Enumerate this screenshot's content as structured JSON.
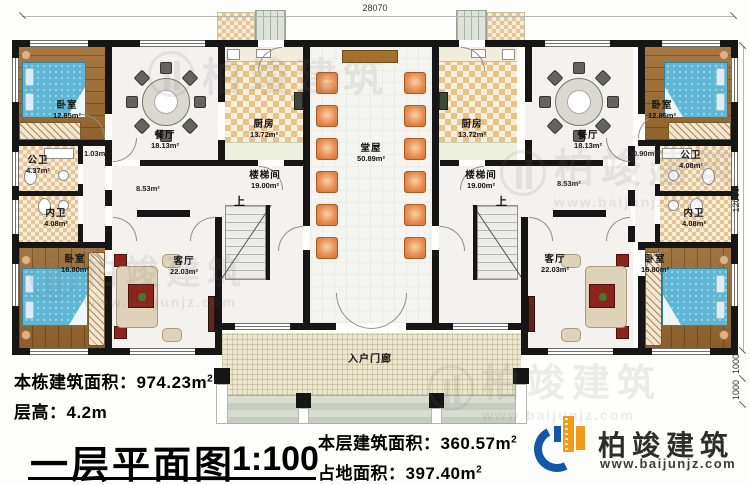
{
  "plan": {
    "rooms": [
      {
        "name": "卧室",
        "area": "12.85m²"
      },
      {
        "name": "餐厅",
        "area": "18.13m²"
      },
      {
        "name": "厨房",
        "area": "13.72m²"
      },
      {
        "name": "堂屋",
        "area": "50.89m²"
      },
      {
        "name": "厨房",
        "area": "13.72m²"
      },
      {
        "name": "餐厅",
        "area": "18.13m²"
      },
      {
        "name": "卧室",
        "area": "12.85m²"
      },
      {
        "name": "公卫",
        "area": "4.37m²"
      },
      {
        "name": "内卫",
        "area": "4.08m²"
      },
      {
        "name": "楼梯间",
        "area": "19.00m²"
      },
      {
        "name": "楼梯间",
        "area": "19.00m²"
      },
      {
        "name": "公卫",
        "area": "4.08m²"
      },
      {
        "name": "内卫",
        "area": "4.08m²"
      },
      {
        "name": "卧室",
        "area": "16.80m²"
      },
      {
        "name": "客厅",
        "area": "22.03m²"
      },
      {
        "name": "客厅",
        "area": "22.03m²"
      },
      {
        "name": "卧室",
        "area": "16.80m²"
      },
      {
        "name": "入户门廊",
        "area": ""
      }
    ],
    "annotations": {
      "closet_left": "1.03m²",
      "corridor_left": "8.53m²",
      "closet_right": "0.90m²",
      "corridor_right": "8.53m²",
      "stairs_up": "上"
    },
    "dimensions": {
      "overall_width": "28070",
      "overall_depth": "12000",
      "porch_depth": "1000",
      "steps_depth": "1000"
    }
  },
  "info": {
    "building_total": {
      "label": "本栋建筑面积：",
      "value": "974.23m",
      "sup": "2"
    },
    "floor_height": {
      "label": "层高：",
      "value": "4.2m"
    },
    "title": "一层平面图",
    "scale": "1:100",
    "floor_area": {
      "label": "本层建筑面积：",
      "value": "360.57m",
      "sup": "2"
    },
    "footprint": {
      "label": "占地面积：",
      "value": "397.40m",
      "sup": "2"
    }
  },
  "logo": {
    "name": "柏竣建筑",
    "url": "www.baijunjz.com"
  },
  "watermark": {
    "text": "柏竣建筑",
    "url": "www.baijunjz.com"
  },
  "colors": {
    "wall": "#161616",
    "wood": "#9a6a30",
    "bed": "#5fb7d5",
    "chair": "#e89055",
    "logo_blue": "#1257a8",
    "logo_orange": "#f39a1b"
  }
}
